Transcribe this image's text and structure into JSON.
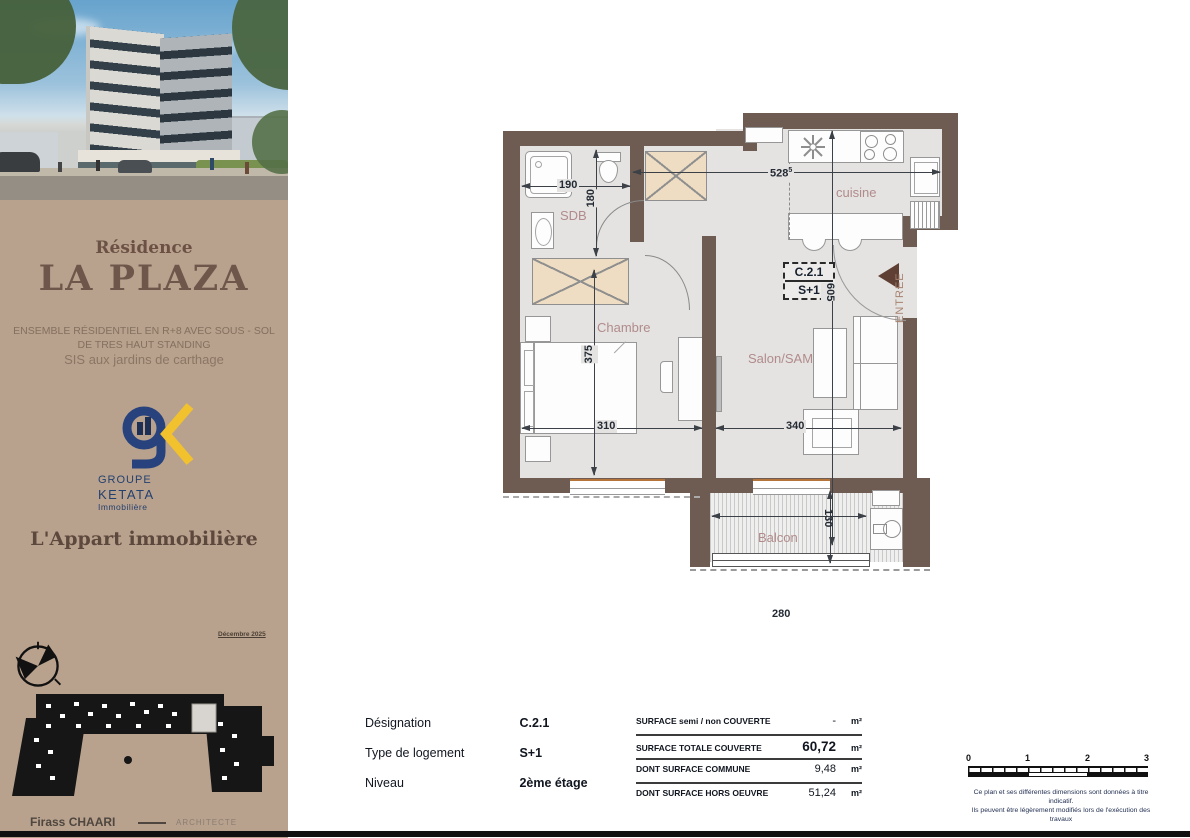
{
  "sidebar": {
    "residence_label": "Résidence",
    "project_name": "LA PLAZA",
    "description": {
      "line1": "ENSEMBLE  RÉSIDENTIEL EN R+8 AVEC SOUS - SOL",
      "line2": "DE TRES HAUT STANDING",
      "line3": "SIS aux jardins de carthage"
    },
    "logo": {
      "line1": "GROUPE",
      "line2": "KETATA",
      "line3": "Immobilière"
    },
    "agency_name": "L'Appart immobilière",
    "plan_date": "Décembre 2025",
    "architect": {
      "name": "Firass CHAARI",
      "title": "ARCHITECTE"
    }
  },
  "floor_plan": {
    "unit_label": {
      "designation": "C.2.1",
      "type": "S+1"
    },
    "rooms": {
      "sdb": "SDB",
      "cuisine": "cuisine",
      "chambre": "Chambre",
      "salon": "Salon/SAM",
      "balcon": "Balcon",
      "entree": "ENTREE"
    },
    "dimensions_cm": {
      "sdb_width": "190",
      "sdb_depth": "180",
      "total_width": "528",
      "total_width_sup": "5",
      "living_depth": "605",
      "chambre_depth": "375",
      "chambre_width": "310",
      "salon_width": "340",
      "balcon_width": "280",
      "balcon_depth": "130"
    }
  },
  "info_table": {
    "rows": [
      {
        "label": "Désignation",
        "value": "C.2.1"
      },
      {
        "label": "Type de logement",
        "value": "S+1"
      },
      {
        "label": "Niveau",
        "value": "2ème étage"
      }
    ]
  },
  "surface_table": {
    "rows": [
      {
        "label": "SURFACE semi / non COUVERTE",
        "value": "-",
        "unit": "m²"
      },
      {
        "label": "SURFACE TOTALE COUVERTE",
        "value": "60,72",
        "unit": "m²"
      },
      {
        "label": "DONT SURFACE COMMUNE",
        "value": "9,48",
        "unit": "m²"
      },
      {
        "label": "DONT SURFACE  HORS OEUVRE",
        "value": "51,24",
        "unit": "m²"
      }
    ]
  },
  "scale_bar": {
    "ticks": [
      "0",
      "1",
      "2",
      "3"
    ]
  },
  "disclaimer": {
    "line1": "Ce plan et ses différentes dimensions sont données à titre indicatif.",
    "line2": "Ils peuvent être légèrement modifiés lors de l'exécution des travaux"
  },
  "colors": {
    "sidebar_bg": "#b9a28d",
    "title_brown": "#6e554a",
    "wall": "#6e5c53",
    "floor": "#e4e3e1",
    "wardrobe": "#eeddc2",
    "room_label": "#b18b8b",
    "logo_navy": "#27427c",
    "logo_yellow": "#f2c12e",
    "entry_arrow": "#5f3f33"
  }
}
